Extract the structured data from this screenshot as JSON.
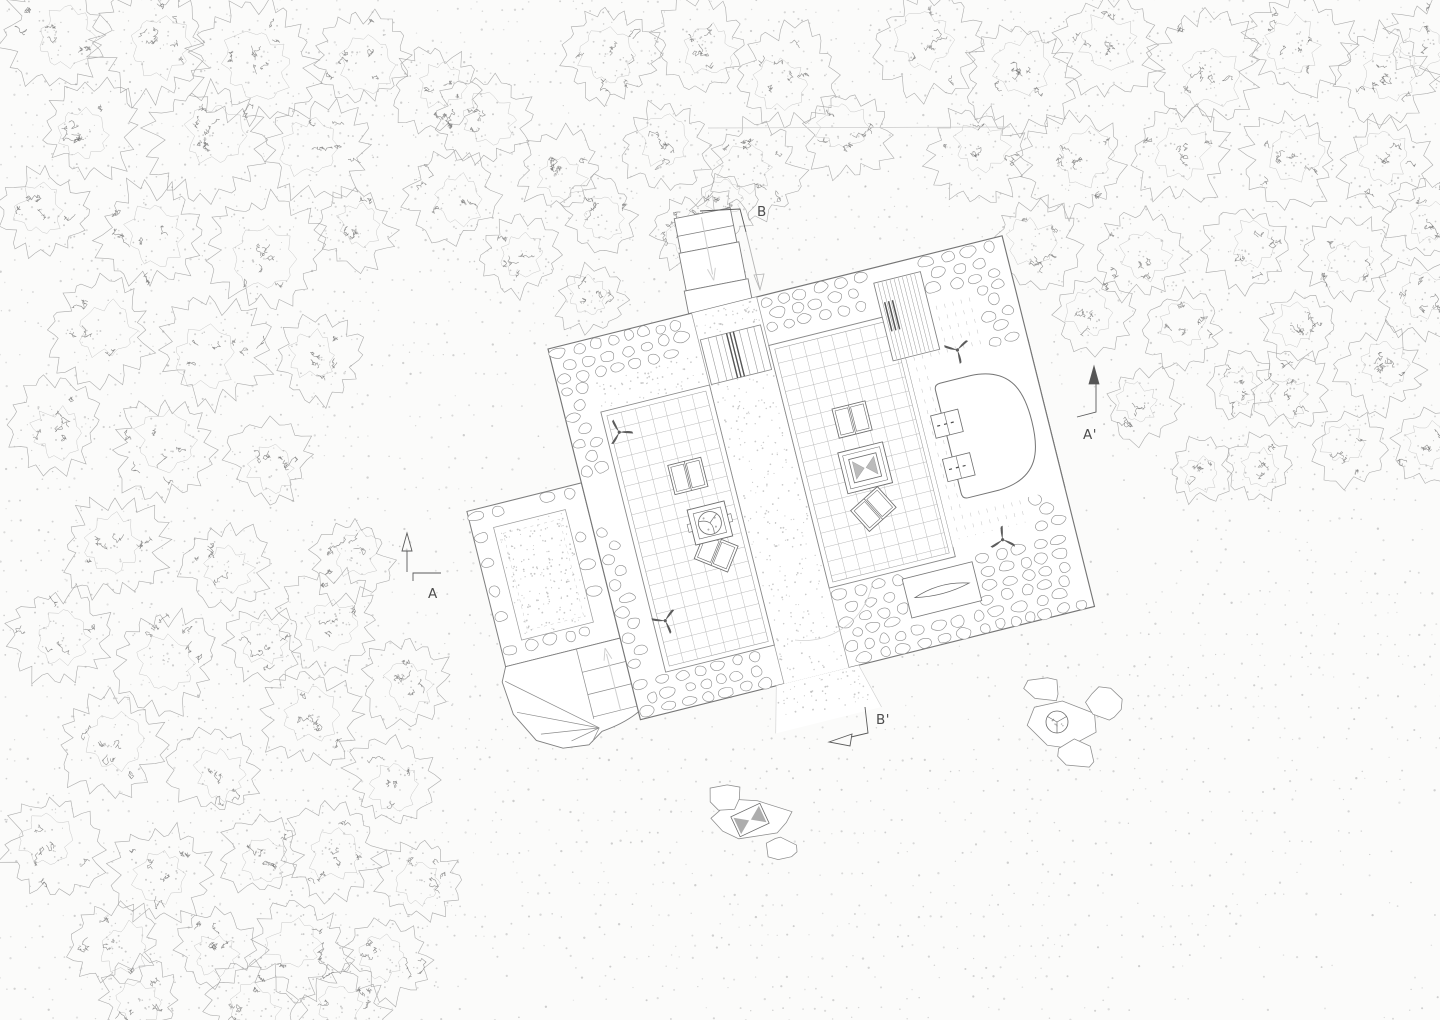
{
  "document": {
    "type": "architectural-site-plan",
    "description": "Hand-drafted plan drawing of a stone cottage in a forest clearing with tiled rooms, central corridor, winder stair, apse alcove, boulder seating groups and section markers"
  },
  "markers": {
    "b": {
      "label": "B"
    },
    "b_prime": {
      "label": "B'"
    },
    "a": {
      "label": "A"
    },
    "a_prime": {
      "label": "A'"
    }
  },
  "drawing": {
    "colors": {
      "background": "#fbfbfa",
      "ink": "#7f7f7f",
      "stone": "#8d8d8d",
      "tile": "#b8b8b8",
      "stipple": "#c6c6c6",
      "tree_line": "#9d9d9d",
      "tree_inner": "#b2b2b2",
      "tree_texture": "#5f5f5f",
      "furniture": "#6e6e6e",
      "faint": "#cfcfcf",
      "label": "#4c4c4c",
      "fill": "#ffffff"
    },
    "seed": 11,
    "building": {
      "x": 548,
      "y": 349,
      "rotation_deg": -14,
      "width": 468,
      "height": 382,
      "wall_thickness": 40
    },
    "trees": [
      [
        55,
        35,
        55
      ],
      [
        150,
        45,
        60
      ],
      [
        255,
        60,
        68
      ],
      [
        360,
        55,
        52
      ],
      [
        435,
        90,
        45
      ],
      [
        90,
        130,
        52
      ],
      [
        205,
        140,
        60
      ],
      [
        320,
        150,
        55
      ],
      [
        480,
        120,
        52
      ],
      [
        560,
        170,
        45
      ],
      [
        450,
        195,
        48
      ],
      [
        45,
        215,
        48
      ],
      [
        150,
        235,
        58
      ],
      [
        265,
        250,
        60
      ],
      [
        355,
        230,
        42
      ],
      [
        520,
        255,
        42
      ],
      [
        590,
        300,
        38
      ],
      [
        100,
        330,
        56
      ],
      [
        215,
        350,
        58
      ],
      [
        320,
        360,
        45
      ],
      [
        55,
        425,
        50
      ],
      [
        165,
        450,
        56
      ],
      [
        270,
        460,
        44
      ],
      [
        115,
        545,
        56
      ],
      [
        225,
        565,
        46
      ],
      [
        350,
        560,
        45
      ],
      [
        60,
        635,
        52
      ],
      [
        165,
        660,
        55
      ],
      [
        265,
        645,
        42
      ],
      [
        330,
        620,
        52
      ],
      [
        405,
        680,
        48
      ],
      [
        110,
        745,
        56
      ],
      [
        215,
        770,
        48
      ],
      [
        310,
        720,
        52
      ],
      [
        390,
        780,
        48
      ],
      [
        55,
        850,
        55
      ],
      [
        160,
        875,
        52
      ],
      [
        260,
        855,
        42
      ],
      [
        330,
        850,
        52
      ],
      [
        420,
        880,
        45
      ],
      [
        115,
        945,
        48
      ],
      [
        215,
        950,
        42
      ],
      [
        300,
        950,
        52
      ],
      [
        390,
        960,
        45
      ],
      [
        345,
        1010,
        45
      ],
      [
        250,
        1000,
        46
      ],
      [
        140,
        1000,
        44
      ],
      [
        610,
        55,
        52
      ],
      [
        700,
        45,
        48
      ],
      [
        790,
        75,
        55
      ],
      [
        665,
        145,
        48
      ],
      [
        755,
        170,
        50
      ],
      [
        850,
        135,
        48
      ],
      [
        600,
        215,
        40
      ],
      [
        690,
        235,
        42
      ],
      [
        725,
        205,
        36
      ],
      [
        930,
        45,
        55
      ],
      [
        1020,
        75,
        58
      ],
      [
        1110,
        45,
        55
      ],
      [
        1205,
        65,
        58
      ],
      [
        1300,
        45,
        55
      ],
      [
        1385,
        75,
        52
      ],
      [
        1430,
        40,
        45
      ],
      [
        975,
        155,
        52
      ],
      [
        1075,
        165,
        55
      ],
      [
        1180,
        155,
        52
      ],
      [
        1290,
        160,
        52
      ],
      [
        1385,
        165,
        48
      ],
      [
        1035,
        245,
        48
      ],
      [
        1140,
        255,
        48
      ],
      [
        1245,
        250,
        44
      ],
      [
        1345,
        255,
        46
      ],
      [
        1425,
        215,
        42
      ],
      [
        1095,
        315,
        44
      ],
      [
        1185,
        330,
        42
      ],
      [
        1145,
        405,
        40
      ],
      [
        1240,
        385,
        36
      ],
      [
        1300,
        330,
        40
      ],
      [
        1290,
        390,
        42
      ],
      [
        1380,
        370,
        46
      ],
      [
        1420,
        300,
        44
      ],
      [
        1350,
        450,
        40
      ],
      [
        1260,
        465,
        36
      ],
      [
        1430,
        450,
        40
      ],
      [
        1200,
        470,
        34
      ]
    ],
    "rocks": {
      "cluster_right": {
        "table": {
          "x": 1057,
          "y": 722,
          "r": 11
        },
        "boulders": [
          [
            1060,
            724,
            36,
            26
          ],
          [
            1044,
            688,
            20,
            14
          ],
          [
            1106,
            702,
            19,
            17
          ],
          [
            1076,
            755,
            20,
            15
          ]
        ]
      },
      "cluster_bottom": {
        "bowtie": {
          "x": 750,
          "y": 820,
          "w": 32,
          "h": 22,
          "rot": -25
        },
        "boulders": [
          [
            752,
            820,
            40,
            23
          ],
          [
            724,
            797,
            19,
            15
          ],
          [
            780,
            849,
            16,
            13
          ]
        ]
      }
    }
  }
}
